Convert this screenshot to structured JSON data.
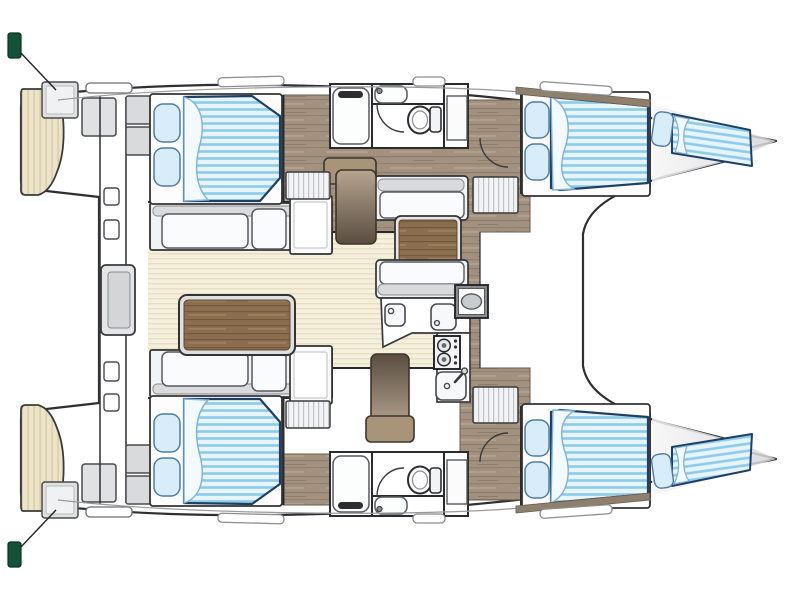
{
  "diagram": {
    "title": "Catamaran yacht floor plan",
    "view": "top-down deck/accommodation layout",
    "orientation": "bows to the right, sterns with swim platforms to the left",
    "hull_count": 2,
    "cabin_count": 4,
    "head_count": 2,
    "forepeak_berths": 2,
    "inventory": {
      "double_beds": 4,
      "pillows_per_bed": 2,
      "bow_berths": 2,
      "toilets": 2,
      "showers": 2,
      "washbasins_heads": 2,
      "galley_sinks": 3,
      "stove_burners": 2,
      "dinette_tables": 1,
      "cockpit_tables": 1,
      "cockpit_bench_cushions": 6,
      "companionway_steps": 2,
      "slatted_step_lockers": 4,
      "swim_platforms": 2,
      "transom_step_boxes": 4,
      "deck_hatches": 6,
      "door_arcs": 4,
      "stern_cleats": 2,
      "wardrobes": 2,
      "headboard_lockers": 4,
      "crossbeam_fittings": 4,
      "helm_seat": 1,
      "oval_galley_appliance": 1
    }
  },
  "colors": {
    "background": "#ffffff",
    "hull_fill": "#ffffff",
    "outline": "#2f2f33",
    "mattress_stripe_light": "#e8f4fb",
    "mattress_stripe_blue": "#8ccbea",
    "mattress_border": "#1d3f66",
    "pillow_fill": "#d9ecf9",
    "sheet_fold": "#f3fafd",
    "wood_floor": "#a39180",
    "wood_grain": "#93816e",
    "table_wood": "#8a6e50",
    "salon_floor_cream": "#f5f0dd",
    "teak_platform": "#ece4c8",
    "furniture_gray": "#e2e3e5",
    "cushion_white": "#fafbfc",
    "cleat_green": "#14503a",
    "bow_shade": "#d9d9db"
  }
}
